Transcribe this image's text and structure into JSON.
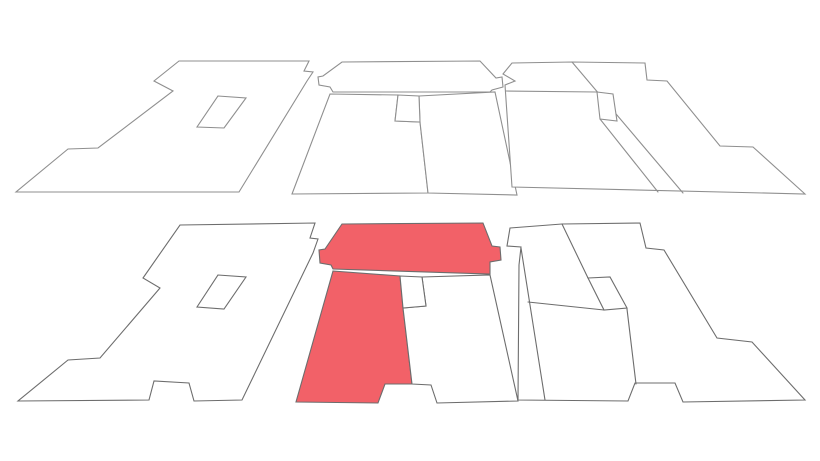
{
  "canvas": {
    "width": 820,
    "height": 461,
    "background": "#ffffff"
  },
  "colors": {
    "highlight": "#f26168",
    "white": "#ffffff",
    "line_top": "#8f8f8f",
    "line_bottom": "#6d6d6d"
  },
  "shapes": [
    {
      "name": "top-left-plate-outline",
      "fill": "white",
      "stroke": "line_top",
      "points": [
        [
          179,
          61
        ],
        [
          309,
          61
        ],
        [
          304,
          71
        ],
        [
          313,
          72
        ],
        [
          307,
          81
        ],
        [
          239,
          192
        ],
        [
          16,
          192
        ],
        [
          68,
          149
        ],
        [
          98,
          148
        ],
        [
          173,
          91
        ],
        [
          154,
          81
        ]
      ]
    },
    {
      "name": "top-middle-band",
      "fill": "white",
      "stroke": "line_top",
      "points": [
        [
          342,
          62
        ],
        [
          480,
          61
        ],
        [
          496,
          78
        ],
        [
          502,
          77
        ],
        [
          503,
          87
        ],
        [
          492,
          90
        ],
        [
          490,
          92
        ],
        [
          333,
          92
        ],
        [
          330,
          87
        ],
        [
          319,
          85
        ],
        [
          318,
          77
        ],
        [
          323,
          76
        ]
      ]
    },
    {
      "name": "top-middle-room-left",
      "fill": "white",
      "stroke": "line_top",
      "points": [
        [
          330,
          94
        ],
        [
          398,
          95
        ],
        [
          395,
          121
        ],
        [
          420,
          122
        ],
        [
          428,
          193
        ],
        [
          292,
          194
        ]
      ]
    },
    {
      "name": "top-middle-room-right",
      "fill": "white",
      "stroke": "line_top",
      "points": [
        [
          419,
          96
        ],
        [
          495,
          92
        ],
        [
          517,
          195
        ],
        [
          428,
          193
        ],
        [
          420,
          122
        ]
      ]
    },
    {
      "name": "top-right-plate-outline",
      "fill": "white",
      "stroke": "line_top",
      "points": [
        [
          512,
          63
        ],
        [
          572,
          62
        ],
        [
          645,
          63
        ],
        [
          647,
          80
        ],
        [
          667,
          81
        ],
        [
          720,
          146
        ],
        [
          753,
          147
        ],
        [
          805,
          194
        ],
        [
          512,
          187
        ],
        [
          505,
          85
        ],
        [
          515,
          81
        ],
        [
          503,
          74
        ]
      ]
    },
    {
      "name": "bottom-left-plate-outline",
      "fill": "white",
      "stroke": "line_bottom",
      "points": [
        [
          180,
          225
        ],
        [
          315,
          223
        ],
        [
          310,
          238
        ],
        [
          318,
          239
        ],
        [
          313,
          253
        ],
        [
          242,
          400
        ],
        [
          194,
          401
        ],
        [
          189,
          383
        ],
        [
          154,
          381
        ],
        [
          149,
          400
        ],
        [
          18,
          401
        ],
        [
          68,
          360
        ],
        [
          100,
          358
        ],
        [
          160,
          288
        ],
        [
          143,
          278
        ]
      ]
    },
    {
      "name": "bottom-middle-band-highlight",
      "fill": "highlight",
      "stroke": "line_bottom",
      "points": [
        [
          342,
          224
        ],
        [
          483,
          223
        ],
        [
          492,
          246
        ],
        [
          500,
          247
        ],
        [
          501,
          260
        ],
        [
          490,
          262
        ],
        [
          490,
          274
        ],
        [
          333,
          269
        ],
        [
          331,
          265
        ],
        [
          320,
          263
        ],
        [
          319,
          250
        ],
        [
          325,
          249
        ]
      ]
    },
    {
      "name": "bottom-middle-room-left-highlight",
      "fill": "highlight",
      "stroke": "line_bottom",
      "points": [
        [
          333,
          271
        ],
        [
          400,
          276
        ],
        [
          403,
          308
        ],
        [
          412,
          384
        ],
        [
          385,
          384
        ],
        [
          378,
          403
        ],
        [
          296,
          402
        ]
      ]
    },
    {
      "name": "bottom-middle-room-right",
      "fill": "white",
      "stroke": "line_bottom",
      "points": [
        [
          422,
          277
        ],
        [
          490,
          275
        ],
        [
          518,
          401
        ],
        [
          437,
          403
        ],
        [
          431,
          385
        ],
        [
          412,
          384
        ],
        [
          403,
          308
        ],
        [
          426,
          306
        ]
      ]
    },
    {
      "name": "bottom-right-plate-outline",
      "fill": "white",
      "stroke": "line_bottom",
      "points": [
        [
          510,
          228
        ],
        [
          562,
          224
        ],
        [
          640,
          223
        ],
        [
          646,
          248
        ],
        [
          664,
          250
        ],
        [
          717,
          338
        ],
        [
          752,
          342
        ],
        [
          805,
          400
        ],
        [
          683,
          402
        ],
        [
          675,
          383
        ],
        [
          635,
          383
        ],
        [
          628,
          401
        ],
        [
          518,
          400
        ],
        [
          519,
          265
        ],
        [
          521,
          247
        ],
        [
          507,
          246
        ]
      ]
    }
  ],
  "segments": [
    {
      "name": "top-right-strip-line",
      "stroke": "line_top",
      "points": [
        [
          506,
          91
        ],
        [
          597,
          92
        ]
      ]
    },
    {
      "name": "top-right-diagonal-divider",
      "stroke": "line_top",
      "points": [
        [
          572,
          62
        ],
        [
          683,
          193
        ]
      ]
    },
    {
      "name": "top-right-lower-divider",
      "stroke": "line_top",
      "points": [
        [
          600,
          119
        ],
        [
          658,
          192
        ]
      ]
    },
    {
      "name": "bottom-right-strip-divider",
      "stroke": "line_bottom",
      "points": [
        [
          521,
          248
        ],
        [
          545,
          400
        ]
      ]
    },
    {
      "name": "bottom-right-diagonal-upper",
      "stroke": "line_bottom",
      "points": [
        [
          562,
          224
        ],
        [
          588,
          278
        ]
      ]
    },
    {
      "name": "bottom-right-diagonal-lower",
      "stroke": "line_bottom",
      "points": [
        [
          627,
          309
        ],
        [
          636,
          384
        ]
      ]
    },
    {
      "name": "bottom-right-cross-line",
      "stroke": "line_bottom",
      "points": [
        [
          528,
          302
        ],
        [
          604,
          310
        ]
      ]
    }
  ],
  "overlays": [
    {
      "name": "top-left-inner-opening",
      "fill": "white",
      "stroke": "line_top",
      "points": [
        [
          218,
          96
        ],
        [
          246,
          98
        ],
        [
          224,
          128
        ],
        [
          197,
          127
        ]
      ]
    },
    {
      "name": "top-middle-small-room",
      "fill": "white",
      "stroke": "line_top",
      "points": [
        [
          398,
          95
        ],
        [
          419,
          96
        ],
        [
          420,
          122
        ],
        [
          395,
          121
        ]
      ]
    },
    {
      "name": "top-right-small-room",
      "fill": "white",
      "stroke": "line_top",
      "points": [
        [
          597,
          92
        ],
        [
          613,
          94
        ],
        [
          617,
          121
        ],
        [
          600,
          119
        ]
      ]
    },
    {
      "name": "bottom-left-inner-opening",
      "fill": "white",
      "stroke": "line_bottom",
      "points": [
        [
          218,
          275
        ],
        [
          246,
          277
        ],
        [
          224,
          309
        ],
        [
          197,
          307
        ]
      ]
    },
    {
      "name": "bottom-middle-small-room",
      "fill": "white",
      "stroke": "line_bottom",
      "points": [
        [
          400,
          276
        ],
        [
          422,
          277
        ],
        [
          426,
          306
        ],
        [
          403,
          308
        ]
      ]
    },
    {
      "name": "bottom-right-inner-opening",
      "fill": "white",
      "stroke": "line_bottom",
      "points": [
        [
          588,
          278
        ],
        [
          610,
          277
        ],
        [
          627,
          308
        ],
        [
          604,
          310
        ]
      ]
    }
  ]
}
